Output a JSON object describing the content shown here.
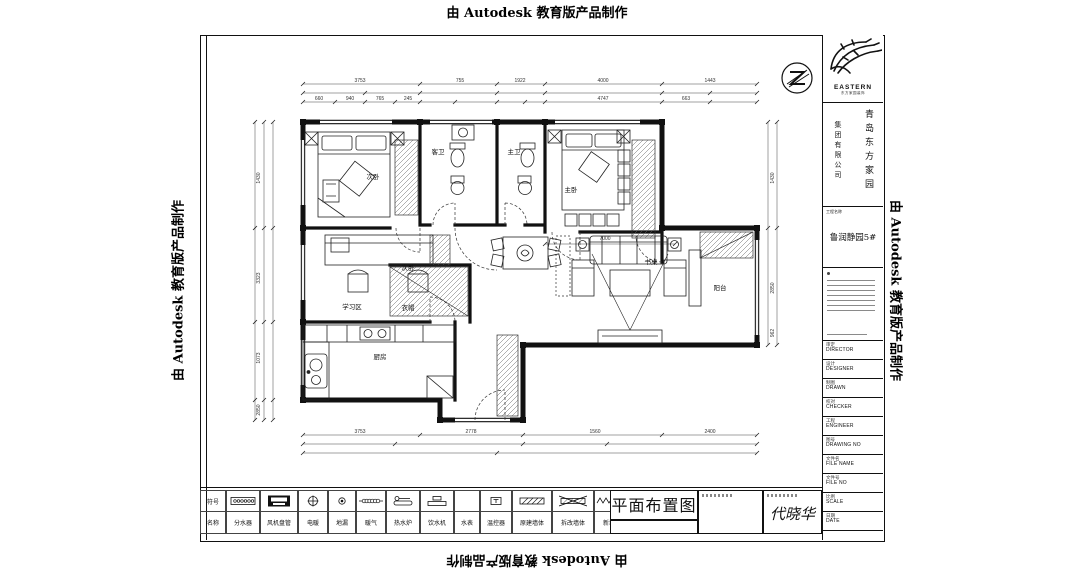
{
  "watermarks": {
    "top": "由 Autodesk 教育版产品制作",
    "bottom": "由 Autodesk 教育版产品制作",
    "left": "由 Autodesk 教育版产品制作",
    "right": "由 Autodesk 教育版产品制作"
  },
  "titleblock": {
    "brand": "EASTERN",
    "brand_sub": "东方家园装饰",
    "company_line1": "青岛东方家园",
    "company_line2": "集团有限公司",
    "project_label": "工程名称",
    "project_name": "鲁润静园5#",
    "fields": [
      {
        "zh": "审定",
        "en": "DIRECTOR"
      },
      {
        "zh": "设计",
        "en": "DESIGNER"
      },
      {
        "zh": "制图",
        "en": "DRAWN"
      },
      {
        "zh": "校对",
        "en": "CHECKER"
      },
      {
        "zh": "工程",
        "en": "ENGINEER"
      },
      {
        "zh": "图号",
        "en": "DRAWING NO"
      },
      {
        "zh": "文件名",
        "en": "FILE NAME"
      },
      {
        "zh": "文件号",
        "en": "FILE NO"
      },
      {
        "zh": "比例",
        "en": "SCALE"
      },
      {
        "zh": "日期",
        "en": "DATE"
      }
    ]
  },
  "legend": {
    "symbol_header": "符号",
    "name_header": "名称",
    "items": [
      {
        "name": "分水器",
        "icon": "manifold-icon"
      },
      {
        "name": "风机盘管",
        "icon": "fan-coil-icon"
      },
      {
        "name": "电暖",
        "icon": "circle-cross-icon"
      },
      {
        "name": "地漏",
        "icon": "floor-drain-icon"
      },
      {
        "name": "暖气",
        "icon": "radiator-icon"
      },
      {
        "name": "热水炉",
        "icon": "boiler-icon"
      },
      {
        "name": "饮水机",
        "icon": "water-dispenser-icon"
      },
      {
        "name": "水表",
        "icon": "blank"
      },
      {
        "name": "温控器",
        "icon": "thermostat-icon"
      },
      {
        "name": "原建墙体",
        "icon": "original-wall-icon"
      },
      {
        "name": "拆改墙体",
        "icon": "demolish-wall-icon"
      },
      {
        "name": "新墙",
        "icon": "new-wall-icon"
      }
    ]
  },
  "footer": {
    "drawing_title": "平面布置图",
    "signature": "代晓华"
  },
  "plan": {
    "rooms": {
      "bedroom2": "次卧",
      "guest_bath": "客卫",
      "master_bath": "主卫",
      "master_bedroom": "主卧",
      "study_bedroom": "次卧",
      "study_area": "学习区",
      "closet": "衣帽",
      "kitchen": "厨房",
      "balcony": "阳台",
      "desk": "书桌"
    },
    "dims": {
      "top_outer": [
        "3753",
        "755",
        "1922",
        "4000",
        "1443"
      ],
      "top_inner": [
        "660",
        "940",
        "765",
        "245",
        "4747",
        "663"
      ],
      "left": [
        "1430",
        "3323",
        "1073",
        "2850"
      ],
      "right": [
        "1430",
        "2850",
        "962"
      ],
      "bottom": [
        "3753",
        "2778",
        "1560",
        "2400"
      ],
      "living_width": "7000"
    }
  },
  "colors": {
    "line": "#111111",
    "paper": "#ffffff"
  }
}
